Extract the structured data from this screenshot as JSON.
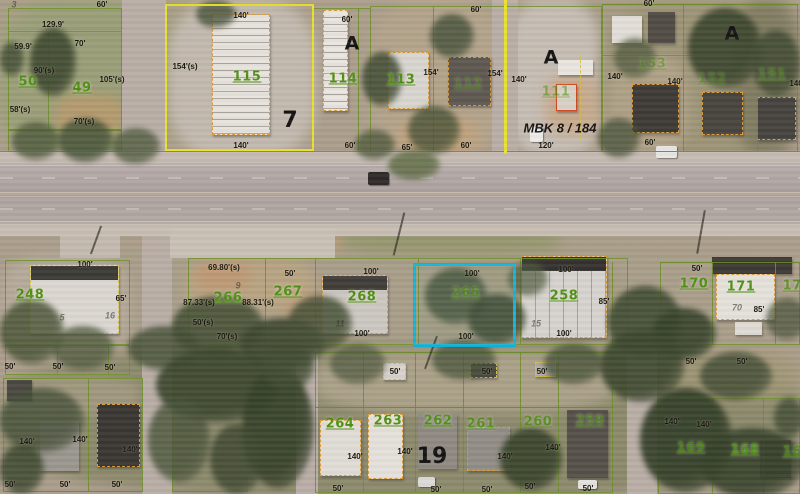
{
  "map": {
    "type": "aerial-parcel-map",
    "highlight_color": "#13b5da",
    "parcel_line_color": "#6e8f2b",
    "block_outline_color": "#e9e32b",
    "building_outline_color": "#d89b3a",
    "selected_parcel": "265"
  },
  "labels": {
    "parcels": [
      {
        "t": "50",
        "x": 28,
        "y": 82
      },
      {
        "t": "49",
        "x": 82,
        "y": 88
      },
      {
        "t": "115",
        "x": 247,
        "y": 77
      },
      {
        "t": "114",
        "x": 343,
        "y": 79
      },
      {
        "t": "113",
        "x": 401,
        "y": 80
      },
      {
        "t": "112",
        "x": 468,
        "y": 84,
        "o": 0.55
      },
      {
        "t": "111",
        "x": 556,
        "y": 92,
        "o": 0.55
      },
      {
        "t": "153",
        "x": 652,
        "y": 64,
        "o": 0.5
      },
      {
        "t": "152",
        "x": 712,
        "y": 79,
        "o": 0.5
      },
      {
        "t": "151",
        "x": 772,
        "y": 75,
        "o": 0.6
      },
      {
        "t": "248",
        "x": 30,
        "y": 295
      },
      {
        "t": "266",
        "x": 228,
        "y": 298
      },
      {
        "t": "267",
        "x": 288,
        "y": 292
      },
      {
        "t": "268",
        "x": 362,
        "y": 297
      },
      {
        "t": "265",
        "x": 466,
        "y": 293,
        "o": 0.8
      },
      {
        "t": "258",
        "x": 564,
        "y": 296
      },
      {
        "t": "170",
        "x": 694,
        "y": 284
      },
      {
        "t": "171",
        "x": 741,
        "y": 287
      },
      {
        "t": "172",
        "x": 797,
        "y": 286,
        "o": 0.8
      },
      {
        "t": "264",
        "x": 340,
        "y": 424
      },
      {
        "t": "263",
        "x": 388,
        "y": 421
      },
      {
        "t": "262",
        "x": 438,
        "y": 421
      },
      {
        "t": "261",
        "x": 481,
        "y": 424,
        "o": 0.85
      },
      {
        "t": "260",
        "x": 538,
        "y": 422,
        "o": 0.8
      },
      {
        "t": "259",
        "x": 590,
        "y": 421,
        "o": 0.8
      },
      {
        "t": "169",
        "x": 691,
        "y": 448,
        "o": 0.8
      },
      {
        "t": "168",
        "x": 745,
        "y": 450
      },
      {
        "t": "167",
        "x": 797,
        "y": 452,
        "o": 0.8
      }
    ],
    "dimensions": [
      {
        "t": "129.9'",
        "x": 53,
        "y": 25
      },
      {
        "t": "59.9'",
        "x": 23,
        "y": 47
      },
      {
        "t": "70'",
        "x": 80,
        "y": 44
      },
      {
        "t": "90'(s)",
        "x": 44,
        "y": 71
      },
      {
        "t": "105'(s)",
        "x": 112,
        "y": 80
      },
      {
        "t": "58'(s)",
        "x": 20,
        "y": 110
      },
      {
        "t": "70'(s)",
        "x": 84,
        "y": 122
      },
      {
        "t": "60'",
        "x": 102,
        "y": 5
      },
      {
        "t": "140'",
        "x": 241,
        "y": 16
      },
      {
        "t": "140'",
        "x": 241,
        "y": 146
      },
      {
        "t": "154'(s)",
        "x": 185,
        "y": 67
      },
      {
        "t": "60'",
        "x": 347,
        "y": 20
      },
      {
        "t": "60'",
        "x": 350,
        "y": 146
      },
      {
        "t": "60'",
        "x": 476,
        "y": 10
      },
      {
        "t": "154'",
        "x": 431,
        "y": 73
      },
      {
        "t": "154'",
        "x": 495,
        "y": 74
      },
      {
        "t": "140'",
        "x": 519,
        "y": 80
      },
      {
        "t": "65'",
        "x": 407,
        "y": 148
      },
      {
        "t": "60'",
        "x": 466,
        "y": 146
      },
      {
        "t": "120'",
        "x": 546,
        "y": 146
      },
      {
        "t": "60'",
        "x": 649,
        "y": 4
      },
      {
        "t": "140'",
        "x": 615,
        "y": 77
      },
      {
        "t": "140'",
        "x": 675,
        "y": 82
      },
      {
        "t": "140'",
        "x": 797,
        "y": 84
      },
      {
        "t": "60'",
        "x": 650,
        "y": 143
      },
      {
        "t": "100'",
        "x": 85,
        "y": 265
      },
      {
        "t": "65'",
        "x": 121,
        "y": 299
      },
      {
        "t": "50'",
        "x": 10,
        "y": 367
      },
      {
        "t": "50'",
        "x": 58,
        "y": 367
      },
      {
        "t": "50'",
        "x": 110,
        "y": 368
      },
      {
        "t": "69.80'(s)",
        "x": 224,
        "y": 268
      },
      {
        "t": "87.33'(s)",
        "x": 199,
        "y": 303
      },
      {
        "t": "88.31'(s)",
        "x": 258,
        "y": 303
      },
      {
        "t": "50'",
        "x": 290,
        "y": 274
      },
      {
        "t": "50'(s)",
        "x": 203,
        "y": 323
      },
      {
        "t": "70'(s)",
        "x": 227,
        "y": 337
      },
      {
        "t": "100'",
        "x": 371,
        "y": 272
      },
      {
        "t": "100'",
        "x": 362,
        "y": 334
      },
      {
        "t": "100'",
        "x": 472,
        "y": 274
      },
      {
        "t": "100'",
        "x": 466,
        "y": 337
      },
      {
        "t": "100'",
        "x": 566,
        "y": 270
      },
      {
        "t": "85'",
        "x": 604,
        "y": 302
      },
      {
        "t": "100'",
        "x": 564,
        "y": 334
      },
      {
        "t": "50'",
        "x": 697,
        "y": 269
      },
      {
        "t": "85'",
        "x": 759,
        "y": 310
      },
      {
        "t": "50'",
        "x": 691,
        "y": 362
      },
      {
        "t": "50'",
        "x": 742,
        "y": 362
      },
      {
        "t": "50'",
        "x": 395,
        "y": 372
      },
      {
        "t": "50'",
        "x": 487,
        "y": 372
      },
      {
        "t": "50'",
        "x": 542,
        "y": 372
      },
      {
        "t": "140'",
        "x": 27,
        "y": 442
      },
      {
        "t": "140'",
        "x": 80,
        "y": 440
      },
      {
        "t": "140'",
        "x": 130,
        "y": 450
      },
      {
        "t": "50'",
        "x": 10,
        "y": 485
      },
      {
        "t": "50'",
        "x": 65,
        "y": 485
      },
      {
        "t": "50'",
        "x": 117,
        "y": 485
      },
      {
        "t": "140'",
        "x": 355,
        "y": 457
      },
      {
        "t": "140'",
        "x": 405,
        "y": 452
      },
      {
        "t": "140'",
        "x": 505,
        "y": 457
      },
      {
        "t": "140'",
        "x": 553,
        "y": 448
      },
      {
        "t": "140'",
        "x": 672,
        "y": 422
      },
      {
        "t": "140'",
        "x": 704,
        "y": 425
      },
      {
        "t": "50'",
        "x": 338,
        "y": 489
      },
      {
        "t": "50'",
        "x": 436,
        "y": 490
      },
      {
        "t": "50'",
        "x": 487,
        "y": 490
      },
      {
        "t": "50'",
        "x": 530,
        "y": 487
      },
      {
        "t": "50'",
        "x": 588,
        "y": 489
      }
    ],
    "block_letters": [
      {
        "t": "7",
        "x": 290,
        "y": 121,
        "s": 22
      },
      {
        "t": "A",
        "x": 352,
        "y": 44,
        "s": 19
      },
      {
        "t": "A",
        "x": 551,
        "y": 58,
        "s": 19
      },
      {
        "t": "A",
        "x": 732,
        "y": 34,
        "s": 19
      },
      {
        "t": "19",
        "x": 432,
        "y": 457,
        "s": 22
      }
    ],
    "notes": [
      {
        "t": "MBK 8 / 184",
        "x": 560,
        "y": 128
      }
    ],
    "faint": [
      {
        "t": "3",
        "x": 14,
        "y": 5
      },
      {
        "t": "9",
        "x": 238,
        "y": 286
      },
      {
        "t": "5",
        "x": 62,
        "y": 318
      },
      {
        "t": "16",
        "x": 110,
        "y": 316
      },
      {
        "t": "11",
        "x": 340,
        "y": 324
      },
      {
        "t": "15",
        "x": 536,
        "y": 324
      },
      {
        "t": "70",
        "x": 737,
        "y": 308
      }
    ]
  }
}
